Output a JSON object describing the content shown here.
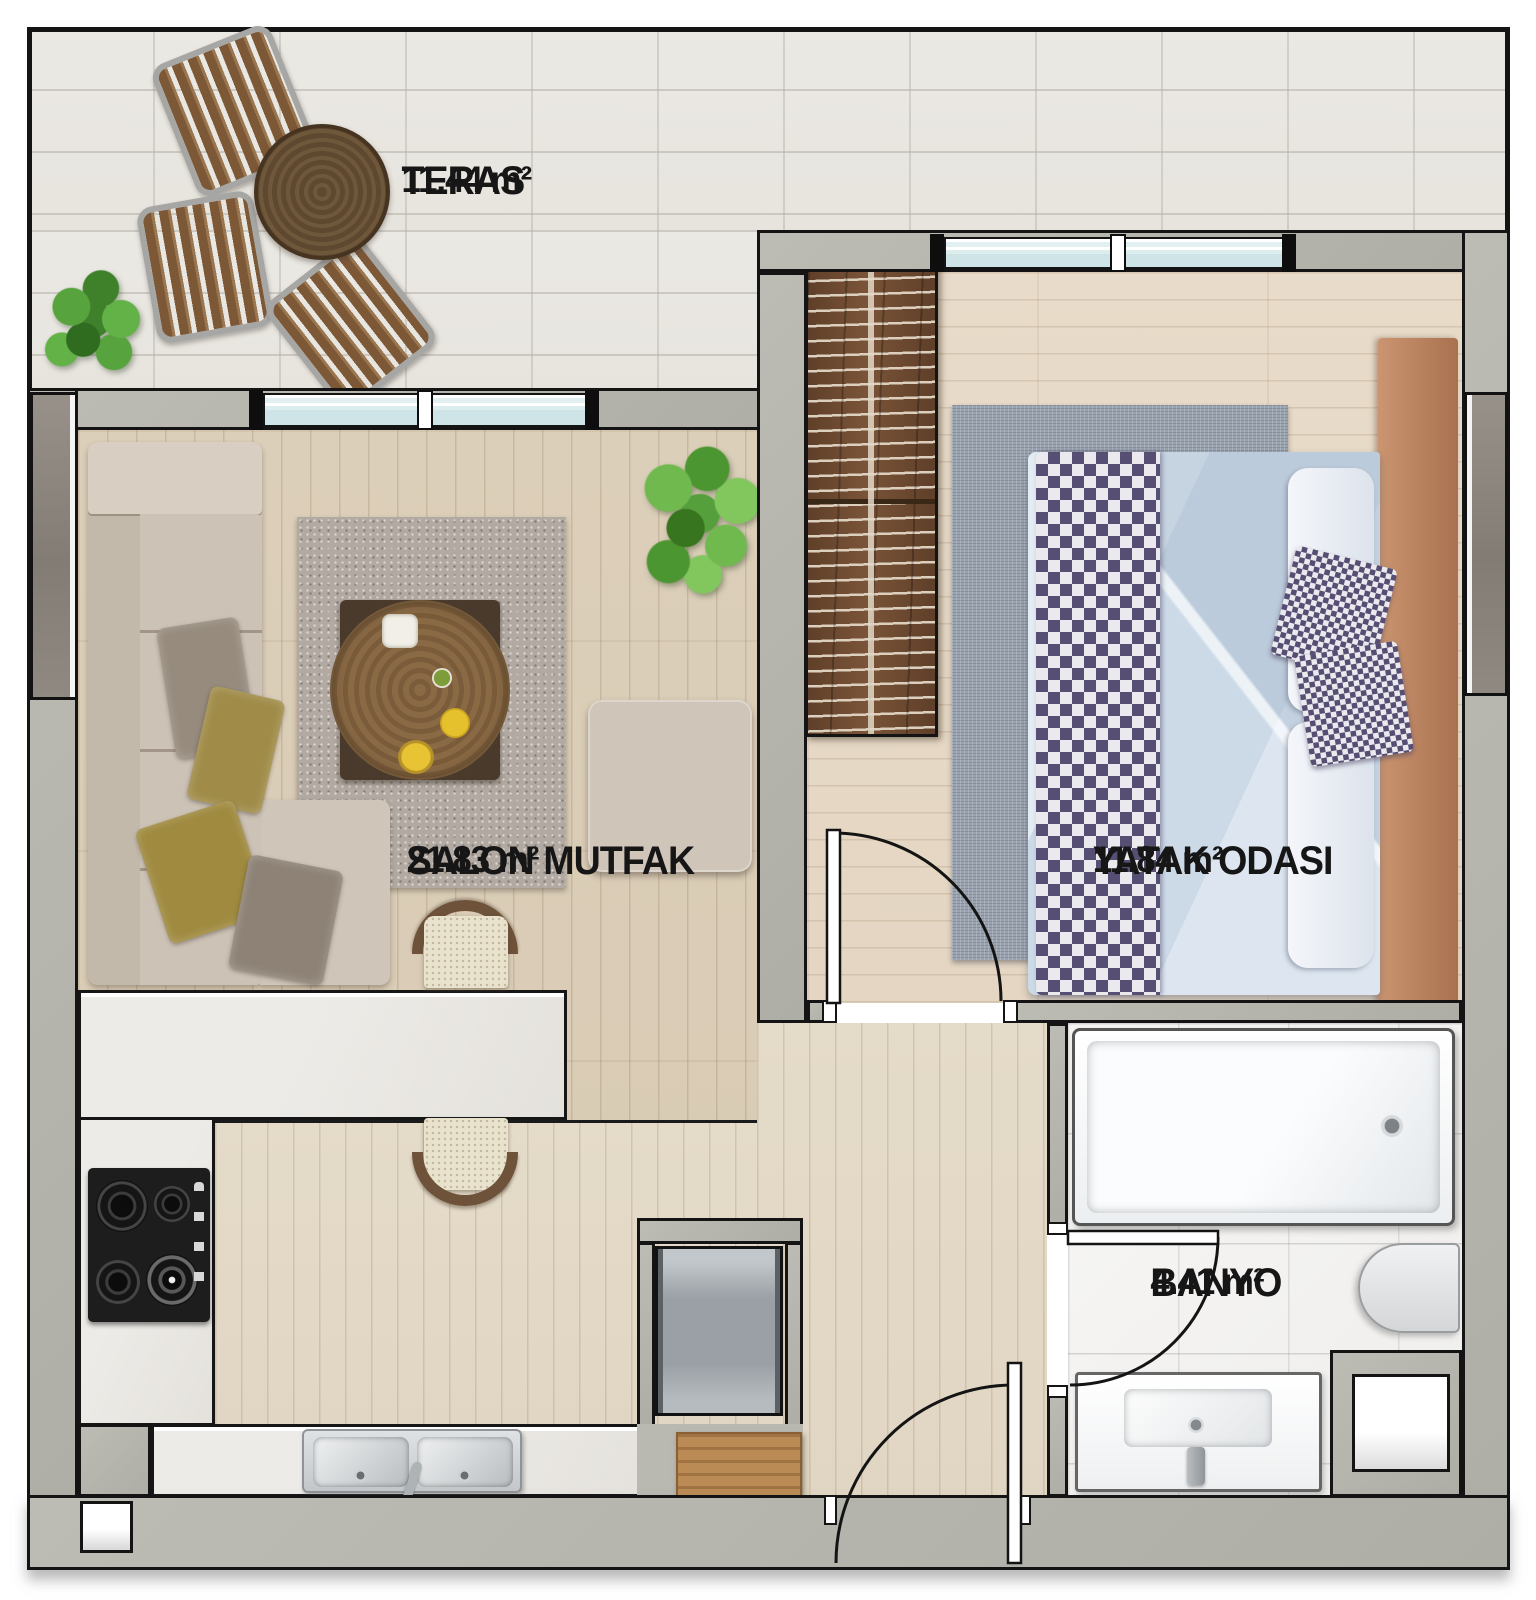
{
  "plan": {
    "kind": "apartment-floor-plan",
    "language": "tr"
  },
  "rooms": {
    "teras": {
      "name": "TERAS",
      "area": "11.44 m²"
    },
    "salon": {
      "name": "SALON MUTFAK",
      "area": "21.83 m²"
    },
    "yatak": {
      "name": "YATAK ODASI",
      "area": "11.84 m²"
    },
    "banyo": {
      "name": "BANYO",
      "area": "4.41 m²"
    }
  },
  "palette": {
    "wall_concrete": "#b4b4ac",
    "outline": "#141414",
    "terrace_tile": "#e9e7e2",
    "wood_living": "#dbcdb7",
    "wood_pale": "#e3d9c7",
    "wood_bedroom": "#e7dac8",
    "bathroom_floor": "#f5f4f2",
    "window_glass": "#d5e9e9",
    "window_panel_dark": "#8b857e",
    "counter_marble": "#eceae6",
    "sofa_beige": "#cdc3b6",
    "pillow_olive": "#9f8c4c",
    "rug_living": "#b2aaa2",
    "rug_bedroom": "#9aa3b0",
    "bed_linen_blue": "#cdd9e6",
    "blanket_checker_purple": "#574e73",
    "wardrobe_brown": "#6f4d34",
    "terrace_wood_brown": "#7c5837",
    "doormat_brown": "#bb8b55",
    "plant_green": "#55a03c",
    "stove_black": "#1d1d1d",
    "steel_sink": "#c9cdd0"
  }
}
